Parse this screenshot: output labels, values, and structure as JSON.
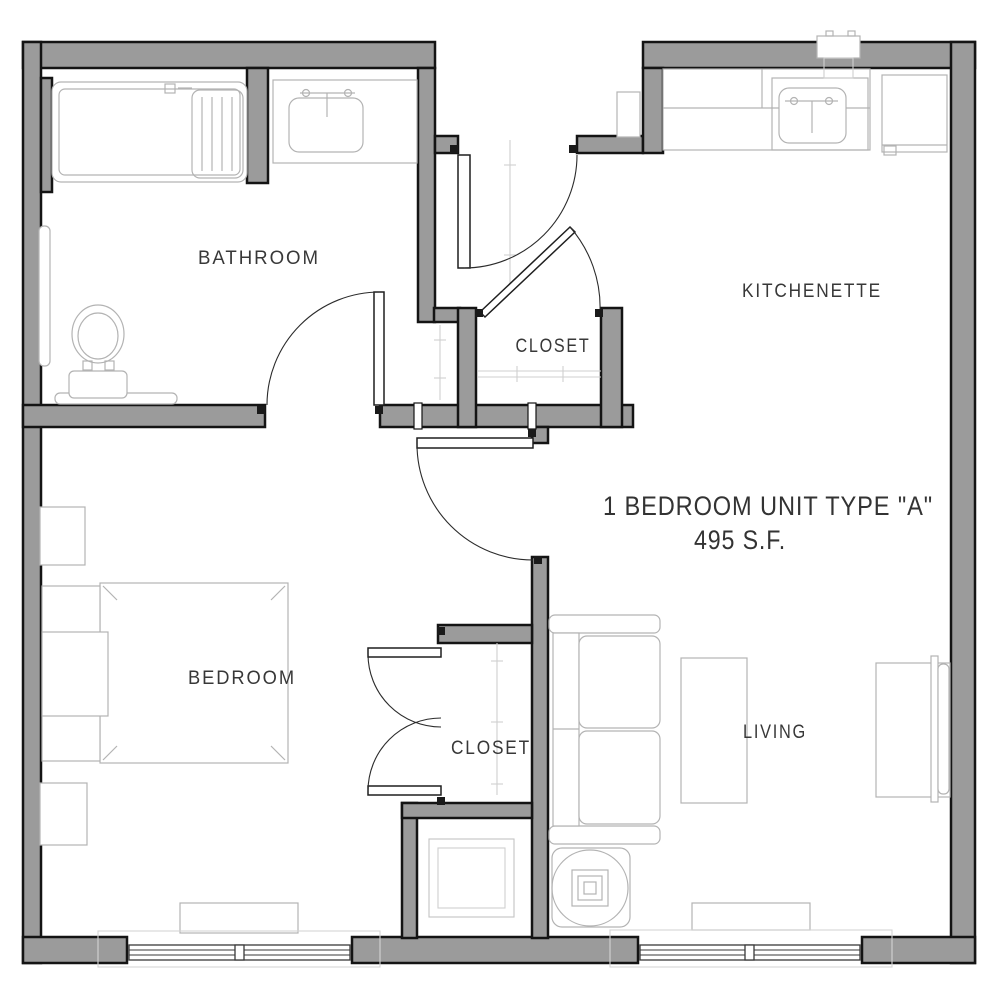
{
  "plan": {
    "title": "1 BEDROOM UNIT TYPE \"A\"",
    "area": "495 S.F.",
    "labels": {
      "bathroom": "BATHROOM",
      "kitchenette": "KITCHENETTE",
      "entry_closet": "CLOSET",
      "bedroom": "BEDROOM",
      "bedroom_closet": "CLOSET",
      "living": "LIVING"
    }
  },
  "fixtures": [
    "bathtub",
    "toilet",
    "vanity-sink",
    "grab-bar",
    "kitchen-counter",
    "kitchen-sink",
    "refrigerator",
    "ptac-unit",
    "entry-niche",
    "entry-door",
    "entry-closet-door",
    "bathroom-door",
    "bedroom-door",
    "closet-double-doors",
    "bed",
    "nightstand",
    "dresser",
    "bedroom-window",
    "living-window",
    "sofa",
    "coffee-table",
    "tv-console",
    "side-table-lamp",
    "utility-unit",
    "closet-rod"
  ],
  "colors": {
    "wall_fill": "#9B9B9B",
    "wall_outline": "#141414",
    "furniture_line": "#B3B3B3",
    "door_line": "#2B2B2B",
    "label_text": "#383838"
  }
}
